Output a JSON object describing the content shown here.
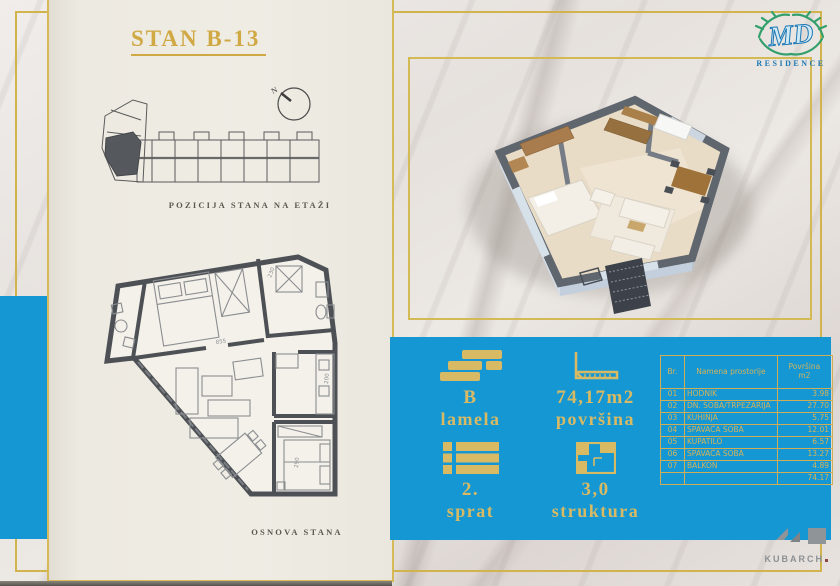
{
  "brand": {
    "monogram": "MD",
    "name": "RESIDENCE"
  },
  "left_panel": {
    "title": "STAN B-13",
    "position_caption": "POZICIJA STANA NA ETAŽI",
    "compass_label": "N",
    "plan_caption": "OSNOVA STANA",
    "plan_dimensions": {
      "d855": "855",
      "d230": "230",
      "d200": "200",
      "d290": "290"
    }
  },
  "info_panel": {
    "items": [
      {
        "value": "B",
        "label": "lamela"
      },
      {
        "value": "74,17m2",
        "label": "površina"
      },
      {
        "value": "2.",
        "label": "sprat"
      },
      {
        "value": "3,0",
        "label": "struktura"
      }
    ]
  },
  "room_table": {
    "header": {
      "num": "Br.",
      "name": "Namena prostorije",
      "area_line1": "Površina",
      "area_line2": "m2"
    },
    "rows": [
      {
        "num": "01",
        "name": "HODNIK",
        "area": "3.98"
      },
      {
        "num": "02",
        "name": "DN. SOBA/TRPEZARIJA",
        "area": "27.70"
      },
      {
        "num": "03",
        "name": "KUHINJA",
        "area": "5.75"
      },
      {
        "num": "04",
        "name": "SPAVAĆA SOBA",
        "area": "12.01"
      },
      {
        "num": "05",
        "name": "KUPATILO",
        "area": "6.57"
      },
      {
        "num": "06",
        "name": "SPAVAĆA SOBA",
        "area": "13.27"
      },
      {
        "num": "07",
        "name": "BALKON",
        "area": "4.89"
      }
    ],
    "total": "74.17"
  },
  "footer": {
    "studio": "KUBARCH"
  },
  "colors": {
    "blue": "#1497d3",
    "gold_text": "#d9ba64",
    "frame_gold": "#d2b44f",
    "beige": "#edeae1",
    "title_gold": "#d0a945"
  }
}
